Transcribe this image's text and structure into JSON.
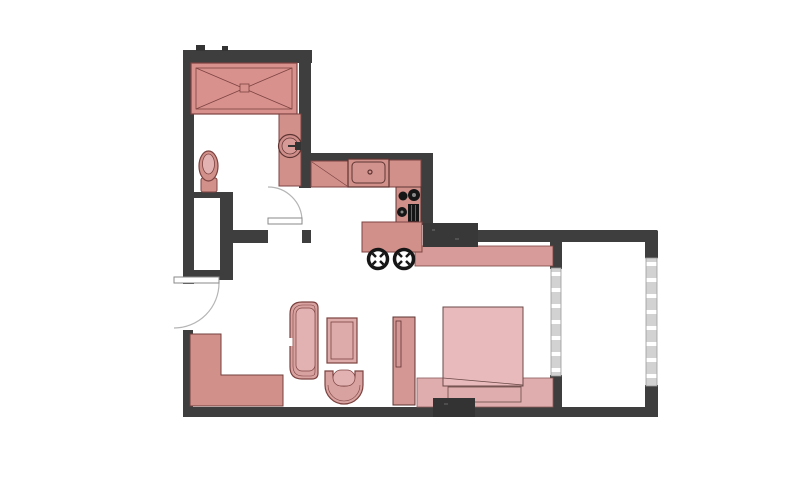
{
  "canvas": {
    "width": 800,
    "height": 480,
    "background": "#ffffff"
  },
  "palette": {
    "wall": "#3e3e3e",
    "wall_dark": "#343434",
    "outline": "#7c4340",
    "outline_dark": "#5d3431",
    "pink": "#d2908b",
    "pink_mid": "#d8a2a0",
    "pink_light": "#e2b2b2",
    "mattress": "#e9babb",
    "platform": "#dfadae",
    "band": "#d79c99",
    "glass": "#d2d2d2",
    "glass_edge": "#9a9a9a",
    "glass_dash": "#ffffff",
    "black": "#161616",
    "burner_dot": "#8a8a8a",
    "door_line": "#8a8a8a",
    "door_arc": "#b5b5b5",
    "white": "#ffffff"
  },
  "elements": [
    {
      "name": "exterior-walls",
      "interactable": false,
      "shapes": [
        {
          "type": "rect",
          "x": 183,
          "y": 50,
          "w": 129,
          "h": 13,
          "fill": "@wall"
        },
        {
          "type": "rect",
          "x": 196,
          "y": 45,
          "w": 9,
          "h": 6,
          "fill": "@wall_dark"
        },
        {
          "type": "rect",
          "x": 222,
          "y": 46,
          "w": 6,
          "h": 5,
          "fill": "@wall_dark"
        },
        {
          "type": "rect",
          "x": 183,
          "y": 50,
          "w": 11,
          "h": 234,
          "fill": "@wall"
        },
        {
          "type": "rect",
          "x": 299,
          "y": 52,
          "w": 12,
          "h": 136,
          "fill": "@wall"
        },
        {
          "type": "rect",
          "x": 311,
          "y": 153,
          "w": 122,
          "h": 10,
          "fill": "@wall"
        },
        {
          "type": "rect",
          "x": 421,
          "y": 153,
          "w": 12,
          "h": 72,
          "fill": "@wall"
        },
        {
          "type": "rect",
          "x": 225,
          "y": 230,
          "w": 43,
          "h": 13,
          "fill": "@wall"
        },
        {
          "type": "rect",
          "x": 302,
          "y": 230,
          "w": 9,
          "h": 13,
          "fill": "@wall"
        },
        {
          "type": "rect",
          "x": 193,
          "y": 192,
          "w": 33,
          "h": 6,
          "fill": "@wall"
        },
        {
          "type": "rect",
          "x": 220,
          "y": 192,
          "w": 13,
          "h": 88,
          "fill": "@wall"
        },
        {
          "type": "rect",
          "x": 183,
          "y": 270,
          "w": 50,
          "h": 10,
          "fill": "@wall"
        },
        {
          "type": "rect",
          "x": 183,
          "y": 330,
          "w": 10,
          "h": 87,
          "fill": "@wall"
        },
        {
          "type": "rect",
          "x": 183,
          "y": 407,
          "w": 475,
          "h": 10,
          "rx": 2,
          "fill": "@wall"
        },
        {
          "type": "rect",
          "x": 428,
          "y": 230,
          "w": 230,
          "h": 12,
          "rx": 2,
          "fill": "@wall"
        },
        {
          "type": "rect",
          "x": 645,
          "y": 230,
          "w": 13,
          "h": 29,
          "rx": 2,
          "fill": "@wall"
        },
        {
          "type": "rect",
          "x": 645,
          "y": 385,
          "w": 13,
          "h": 32,
          "fill": "@wall"
        },
        {
          "type": "rect",
          "x": 550,
          "y": 242,
          "w": 12,
          "h": 27,
          "fill": "@wall"
        },
        {
          "type": "rect",
          "x": 550,
          "y": 375,
          "w": 12,
          "h": 32,
          "fill": "@wall"
        }
      ]
    },
    {
      "name": "balcony-right-window",
      "interactable": false,
      "shapes": [
        {
          "type": "rect",
          "x": 646,
          "y": 258,
          "w": 11,
          "h": 128,
          "fill": "@glass",
          "stroke": "@glass_edge",
          "sw": 0.8
        },
        {
          "type": "line",
          "x1": 651.5,
          "y1": 262,
          "x2": 651.5,
          "y2": 384,
          "stroke": "@glass_dash",
          "sw": 10,
          "dash": "4 12"
        }
      ]
    },
    {
      "name": "bedroom-balcony-window",
      "interactable": false,
      "shapes": [
        {
          "type": "rect",
          "x": 551,
          "y": 268,
          "w": 10,
          "h": 108,
          "fill": "@glass",
          "stroke": "@glass_edge",
          "sw": 0.8
        },
        {
          "type": "line",
          "x1": 556,
          "y1": 272,
          "x2": 556,
          "y2": 373,
          "stroke": "@glass_dash",
          "sw": 9,
          "dash": "4 12"
        }
      ]
    },
    {
      "name": "wardrobe-closet",
      "interactable": false,
      "shapes": [
        {
          "type": "rect",
          "x": 191,
          "y": 63,
          "w": 106,
          "h": 51,
          "fill": "#d9918e",
          "stroke": "@outline",
          "sw": 1.2
        },
        {
          "type": "rect",
          "x": 196,
          "y": 68,
          "w": 96,
          "h": 41,
          "fill": "none",
          "stroke": "@outline",
          "sw": 0.8
        },
        {
          "type": "line",
          "x1": 196,
          "y1": 68,
          "x2": 292,
          "y2": 109,
          "stroke": "@outline",
          "sw": 0.8
        },
        {
          "type": "line",
          "x1": 196,
          "y1": 109,
          "x2": 292,
          "y2": 68,
          "stroke": "@outline",
          "sw": 0.8
        },
        {
          "type": "rect",
          "x": 240,
          "y": 84,
          "w": 9,
          "h": 8,
          "fill": "#d9918e",
          "stroke": "@outline",
          "sw": 0.8
        }
      ]
    },
    {
      "name": "bathroom-vanity",
      "interactable": false,
      "shapes": [
        {
          "type": "rect",
          "x": 279,
          "y": 114,
          "w": 22,
          "h": 72,
          "fill": "@pink",
          "stroke": "@outline",
          "sw": 1
        },
        {
          "type": "circle",
          "cx": 290,
          "cy": 146,
          "r": 11.5,
          "fill": "#cf8e8a",
          "stroke": "@outline_dark",
          "sw": 1.2
        },
        {
          "type": "circle",
          "cx": 290,
          "cy": 146,
          "r": 8,
          "fill": "#d89a96",
          "stroke": "@outline_dark",
          "sw": 0.7
        },
        {
          "type": "rect",
          "x": 295,
          "y": 142,
          "w": 6,
          "h": 8,
          "fill": "#333333"
        },
        {
          "type": "line",
          "x1": 288,
          "y1": 146,
          "x2": 296,
          "y2": 146,
          "stroke": "#333333",
          "sw": 2
        }
      ]
    },
    {
      "name": "toilet",
      "interactable": false,
      "shapes": [
        {
          "type": "rect",
          "x": 201,
          "y": 178,
          "w": 16,
          "h": 14,
          "rx": 2,
          "fill": "@pink",
          "stroke": "@outline",
          "sw": 1
        },
        {
          "type": "ellipse",
          "cx": 208.5,
          "cy": 166,
          "rx": 9.5,
          "ry": 15,
          "fill": "@pink",
          "stroke": "@outline",
          "sw": 1.2
        },
        {
          "type": "ellipse",
          "cx": 208.5,
          "cy": 164,
          "rx": 6,
          "ry": 10,
          "fill": "@pink_light",
          "stroke": "@outline",
          "sw": 0.8
        }
      ]
    },
    {
      "name": "kitchen-counter",
      "interactable": false,
      "shapes": [
        {
          "type": "rect",
          "x": 311,
          "y": 161,
          "w": 37,
          "h": 26,
          "fill": "@pink",
          "stroke": "@outline",
          "sw": 1
        },
        {
          "type": "line",
          "x1": 312,
          "y1": 162,
          "x2": 347,
          "y2": 186,
          "stroke": "@outline",
          "sw": 0.7
        },
        {
          "type": "rect",
          "x": 389,
          "y": 160,
          "w": 32,
          "h": 27,
          "fill": "@pink",
          "stroke": "@outline",
          "sw": 1
        }
      ]
    },
    {
      "name": "kitchen-sink",
      "interactable": false,
      "shapes": [
        {
          "type": "rect",
          "x": 348,
          "y": 159,
          "w": 41,
          "h": 28,
          "fill": "@pink",
          "stroke": "@outline_dark",
          "sw": 1.2
        },
        {
          "type": "rect",
          "x": 352,
          "y": 162,
          "w": 33,
          "h": 21,
          "rx": 4,
          "fill": "#d2938f",
          "stroke": "@outline_dark",
          "sw": 1
        },
        {
          "type": "circle",
          "cx": 370,
          "cy": 172,
          "r": 2,
          "fill": "none",
          "stroke": "@outline_dark",
          "sw": 1.2
        }
      ]
    },
    {
      "name": "kitchen-stove",
      "interactable": false,
      "shapes": [
        {
          "type": "rect",
          "x": 396,
          "y": 187,
          "w": 25,
          "h": 36,
          "fill": "@pink",
          "stroke": "@outline_dark",
          "sw": 1
        },
        {
          "type": "circle",
          "cx": 403,
          "cy": 196,
          "r": 4.5,
          "fill": "@black"
        },
        {
          "type": "circle",
          "cx": 414,
          "cy": 195,
          "r": 6,
          "fill": "@black"
        },
        {
          "type": "circle",
          "cx": 414,
          "cy": 195,
          "r": 2,
          "fill": "@burner_dot"
        },
        {
          "type": "circle",
          "cx": 402,
          "cy": 212,
          "r": 5,
          "fill": "@black"
        },
        {
          "type": "circle",
          "cx": 402,
          "cy": 212,
          "r": 1.5,
          "fill": "@burner_dot"
        },
        {
          "type": "rect",
          "x": 408,
          "y": 204,
          "w": 11,
          "h": 18,
          "fill": "@black"
        },
        {
          "type": "line",
          "x1": 411.5,
          "y1": 205,
          "x2": 411.5,
          "y2": 221,
          "stroke": "#8c5450",
          "sw": 1
        },
        {
          "type": "line",
          "x1": 415.5,
          "y1": 205,
          "x2": 415.5,
          "y2": 221,
          "stroke": "#8c5450",
          "sw": 1
        }
      ]
    },
    {
      "name": "desk-counter",
      "interactable": false,
      "shapes": [
        {
          "type": "rect",
          "x": 415,
          "y": 246,
          "w": 138,
          "h": 20,
          "fill": "@band",
          "stroke": "@outline",
          "sw": 0.8
        }
      ]
    },
    {
      "name": "kitchen-island",
      "interactable": false,
      "shapes": [
        {
          "type": "rect",
          "x": 362,
          "y": 222,
          "w": 60,
          "h": 30,
          "fill": "@pink",
          "stroke": "@outline",
          "sw": 1
        }
      ]
    },
    {
      "name": "structural-column",
      "interactable": false,
      "shapes": [
        {
          "type": "rect",
          "x": 423,
          "y": 223,
          "w": 55,
          "h": 24,
          "fill": "#383838"
        },
        {
          "type": "rect",
          "x": 432,
          "y": 229,
          "w": 3,
          "h": 2,
          "fill": "#555555"
        },
        {
          "type": "rect",
          "x": 455,
          "y": 238,
          "w": 4,
          "h": 2,
          "fill": "#525252"
        }
      ]
    },
    {
      "name": "storage-bench",
      "interactable": false,
      "shapes": [
        {
          "type": "path",
          "d": "M190,334 L221,334 L221,375 L283,375 L283,406 L190,406 Z",
          "fill": "@pink",
          "stroke": "#70403d",
          "sw": 1
        }
      ]
    },
    {
      "name": "sofa",
      "interactable": false,
      "shapes": [
        {
          "type": "path",
          "d": "M318,308 Q318,302 312,302 L302,302 Q290,302 290,314 L290,367 Q290,379 302,379 L312,379 Q318,379 318,373 Z",
          "fill": "@pink_mid",
          "stroke": "@outline",
          "sw": 1.2
        },
        {
          "type": "path",
          "d": "M315,309 Q315,305 311,305 L303,305 Q293,305 293,315 L293,366 Q293,376 303,376 L311,376 Q315,376 315,372 Z",
          "fill": "none",
          "stroke": "@outline",
          "sw": 0.6
        },
        {
          "type": "rect",
          "x": 296,
          "y": 308,
          "w": 19,
          "h": 63,
          "rx": 6,
          "fill": "@pink_light",
          "stroke": "@outline",
          "sw": 0.7
        },
        {
          "type": "rect",
          "x": 288.5,
          "y": 338,
          "w": 4,
          "h": 8,
          "fill": "@white"
        }
      ]
    },
    {
      "name": "coffee-table",
      "interactable": false,
      "shapes": [
        {
          "type": "rect",
          "x": 327,
          "y": 318,
          "w": 30,
          "h": 45,
          "fill": "#dcabaa",
          "stroke": "@outline",
          "sw": 1.2
        },
        {
          "type": "rect",
          "x": 331,
          "y": 322,
          "w": 22,
          "h": 37,
          "fill": "none",
          "stroke": "@outline",
          "sw": 0.8
        }
      ]
    },
    {
      "name": "lounge-chair",
      "interactable": false,
      "shapes": [
        {
          "type": "path",
          "d": "M325,371 L333,371 L333,375 A11,11 0 0 0 355,375 L355,371 L363,371 L363,385 A19,19 0 0 1 325,385 Z",
          "fill": "@pink_mid",
          "stroke": "@outline",
          "sw": 1.2
        },
        {
          "type": "path",
          "d": "M328,385 A16,16 0 0 0 360,385",
          "fill": "none",
          "stroke": "@outline",
          "sw": 0.6
        },
        {
          "type": "rect",
          "x": 333,
          "y": 370,
          "w": 22,
          "h": 16,
          "rx": 8,
          "fill": "@pink_light",
          "stroke": "@outline",
          "sw": 0.7
        }
      ]
    },
    {
      "name": "bedroom-shelf",
      "interactable": false,
      "shapes": [
        {
          "type": "rect",
          "x": 393,
          "y": 317,
          "w": 22,
          "h": 88,
          "fill": "#d49794",
          "stroke": "@outline_dark",
          "sw": 1
        },
        {
          "type": "rect",
          "x": 396,
          "y": 321,
          "w": 5,
          "h": 46,
          "fill": "none",
          "stroke": "@outline_dark",
          "sw": 0.8
        }
      ]
    },
    {
      "name": "bed-platform",
      "interactable": false,
      "shapes": [
        {
          "type": "rect",
          "x": 417,
          "y": 378,
          "w": 136,
          "h": 29,
          "fill": "@platform",
          "stroke": "#8a5a58",
          "sw": 0.8
        }
      ]
    },
    {
      "name": "bed",
      "interactable": false,
      "shapes": [
        {
          "type": "rect",
          "x": 443,
          "y": 307,
          "w": 80,
          "h": 79,
          "fill": "@mattress",
          "stroke": "#6b4a48",
          "sw": 1
        },
        {
          "type": "line",
          "x1": 443,
          "y1": 378,
          "x2": 523,
          "y2": 385,
          "stroke": "#6b4a48",
          "sw": 0.8
        },
        {
          "type": "rect",
          "x": 448,
          "y": 387,
          "w": 73,
          "h": 15,
          "fill": "@platform",
          "stroke": "#6b4a48",
          "sw": 0.8
        }
      ]
    },
    {
      "name": "bottom-dark-block",
      "interactable": false,
      "shapes": [
        {
          "type": "rect",
          "x": 433,
          "y": 398,
          "w": 42,
          "h": 19,
          "fill": "#333333"
        },
        {
          "type": "rect",
          "x": 444,
          "y": 403,
          "w": 4,
          "h": 2,
          "fill": "#4e4e4e"
        }
      ]
    },
    {
      "name": "bar-stool-left",
      "interactable": false,
      "shapes": [
        {
          "type": "circle",
          "cx": 378,
          "cy": 259,
          "r": 9.5,
          "fill": "@white",
          "stroke": "@black",
          "sw": 3.5
        },
        {
          "type": "line",
          "x1": 372.5,
          "y1": 253.5,
          "x2": 376,
          "y2": 257,
          "stroke": "@black",
          "sw": 2.5
        },
        {
          "type": "line",
          "x1": 383.5,
          "y1": 253.5,
          "x2": 380,
          "y2": 257,
          "stroke": "@black",
          "sw": 2.5
        },
        {
          "type": "line",
          "x1": 372.5,
          "y1": 264.5,
          "x2": 376,
          "y2": 261,
          "stroke": "@black",
          "sw": 2.5
        },
        {
          "type": "line",
          "x1": 383.5,
          "y1": 264.5,
          "x2": 380,
          "y2": 261,
          "stroke": "@black",
          "sw": 2.5
        }
      ]
    },
    {
      "name": "bar-stool-right",
      "interactable": false,
      "shapes": [
        {
          "type": "circle",
          "cx": 404,
          "cy": 259,
          "r": 9.5,
          "fill": "@white",
          "stroke": "@black",
          "sw": 3.5
        },
        {
          "type": "line",
          "x1": 398.5,
          "y1": 253.5,
          "x2": 402,
          "y2": 257,
          "stroke": "@black",
          "sw": 2.5
        },
        {
          "type": "line",
          "x1": 409.5,
          "y1": 253.5,
          "x2": 406,
          "y2": 257,
          "stroke": "@black",
          "sw": 2.5
        },
        {
          "type": "line",
          "x1": 398.5,
          "y1": 264.5,
          "x2": 402,
          "y2": 261,
          "stroke": "@black",
          "sw": 2.5
        },
        {
          "type": "line",
          "x1": 409.5,
          "y1": 264.5,
          "x2": 406,
          "y2": 261,
          "stroke": "@black",
          "sw": 2.5
        }
      ]
    },
    {
      "name": "entry-door",
      "interactable": false,
      "shapes": [
        {
          "type": "path",
          "d": "M219,283 A45,45 0 0 1 174,328",
          "fill": "none",
          "stroke": "@door_arc",
          "sw": 1.2
        },
        {
          "type": "rect",
          "x": 174,
          "y": 277,
          "w": 45,
          "h": 6,
          "fill": "@white",
          "stroke": "@door_line",
          "sw": 1
        }
      ]
    },
    {
      "name": "bathroom-door",
      "interactable": false,
      "shapes": [
        {
          "type": "path",
          "d": "M302,221 A34,34 0 0 0 268,187",
          "fill": "none",
          "stroke": "@door_arc",
          "sw": 1.2
        },
        {
          "type": "rect",
          "x": 268,
          "y": 218,
          "w": 34,
          "h": 6,
          "fill": "@white",
          "stroke": "@door_line",
          "sw": 1
        }
      ]
    }
  ]
}
